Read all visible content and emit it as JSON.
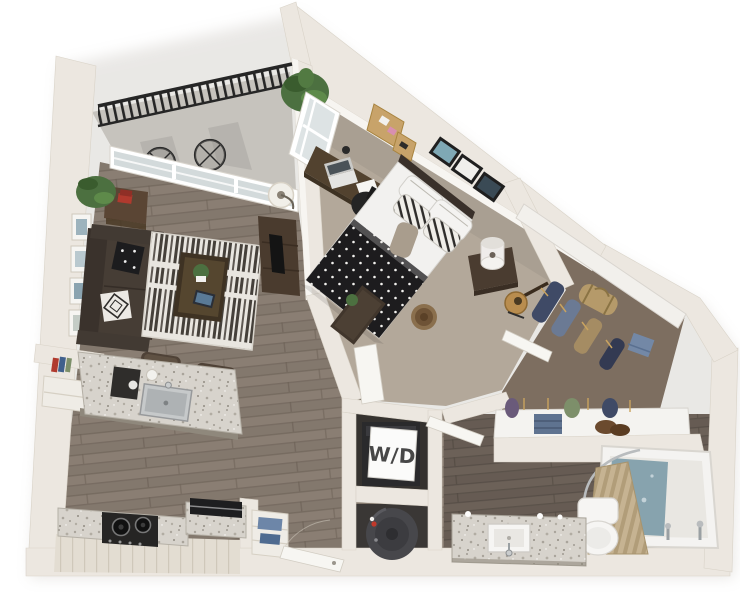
{
  "canvas": {
    "width": 740,
    "height": 592,
    "background": "#ffffff"
  },
  "labels": {
    "washer_dryer": "W/D"
  },
  "palette": {
    "wall_top": "#ece7e0",
    "wall_face": "#f7f5f1",
    "wall_shade": "#d5cec3",
    "wood": "#8a7e73",
    "wood_line": "#6f6459",
    "wood_dark": "#6c6158",
    "carpet": "#b3a89a",
    "closet_floor": "#7d6e60",
    "balcony_floor": "#c6c3bd",
    "granite": "#d7d3cc",
    "cabinet": "#e3ddd2",
    "sofa": "#463d35",
    "wood_furniture": "#4e4132",
    "rug_base": "#e9e6e0",
    "rug_stripe": "#45403a",
    "blanket": "#1d1c1e",
    "water": "#87a3ae",
    "curtain": "#c6b392",
    "railing": "#262626",
    "plant": "#4c7040",
    "appliance": "#2a2a2c",
    "door_white": "#f7f6f2",
    "label_ink": "#474747"
  },
  "rooms": [
    {
      "id": "balcony",
      "name": "balcony",
      "furniture": [
        "railing",
        "wire-chair",
        "wire-chair",
        "potted-plant"
      ]
    },
    {
      "id": "living-room",
      "name": "living-room",
      "furniture": [
        "sofa",
        "throw-pillows",
        "area-rug",
        "coffee-table",
        "tv-console",
        "tv",
        "side-table",
        "floor-lamp",
        "wall-art-frames",
        "potted-plant",
        "sliding-glass-door"
      ]
    },
    {
      "id": "kitchen",
      "name": "kitchen",
      "furniture": [
        "island",
        "island-sink",
        "coffee-maker",
        "bar-stool",
        "bar-stool",
        "range-stove",
        "counter",
        "base-cabinets",
        "bookshelf-cabinet"
      ]
    },
    {
      "id": "entry",
      "name": "entry",
      "furniture": [
        "entry-door",
        "pantry-shelf"
      ]
    },
    {
      "id": "bedroom",
      "name": "bedroom",
      "furniture": [
        "bed",
        "pillows",
        "polka-dot-blanket",
        "nightstand",
        "table-lamp",
        "desk",
        "desk-chair",
        "laptop",
        "window",
        "corkboard",
        "picture-frames",
        "guitar",
        "storage-bench",
        "round-basket",
        "bedroom-door"
      ]
    },
    {
      "id": "walk-in-closet",
      "name": "walk-in-closet",
      "furniture": [
        "shelving",
        "hanging-clothes",
        "duffel-bag",
        "folded-clothes",
        "shoes",
        "closet-door"
      ]
    },
    {
      "id": "bathroom",
      "name": "bathroom",
      "furniture": [
        "vanity",
        "vanity-sink",
        "toilet",
        "bathtub",
        "tub-water",
        "shower-curtain",
        "shower-rod",
        "bathroom-door"
      ]
    },
    {
      "id": "laundry-closet",
      "name": "laundry-closet",
      "furniture": [
        "stacked-washer-dryer",
        "wd-placard"
      ]
    },
    {
      "id": "utility-closet",
      "name": "utility-closet",
      "furniture": [
        "water-heater"
      ]
    }
  ]
}
